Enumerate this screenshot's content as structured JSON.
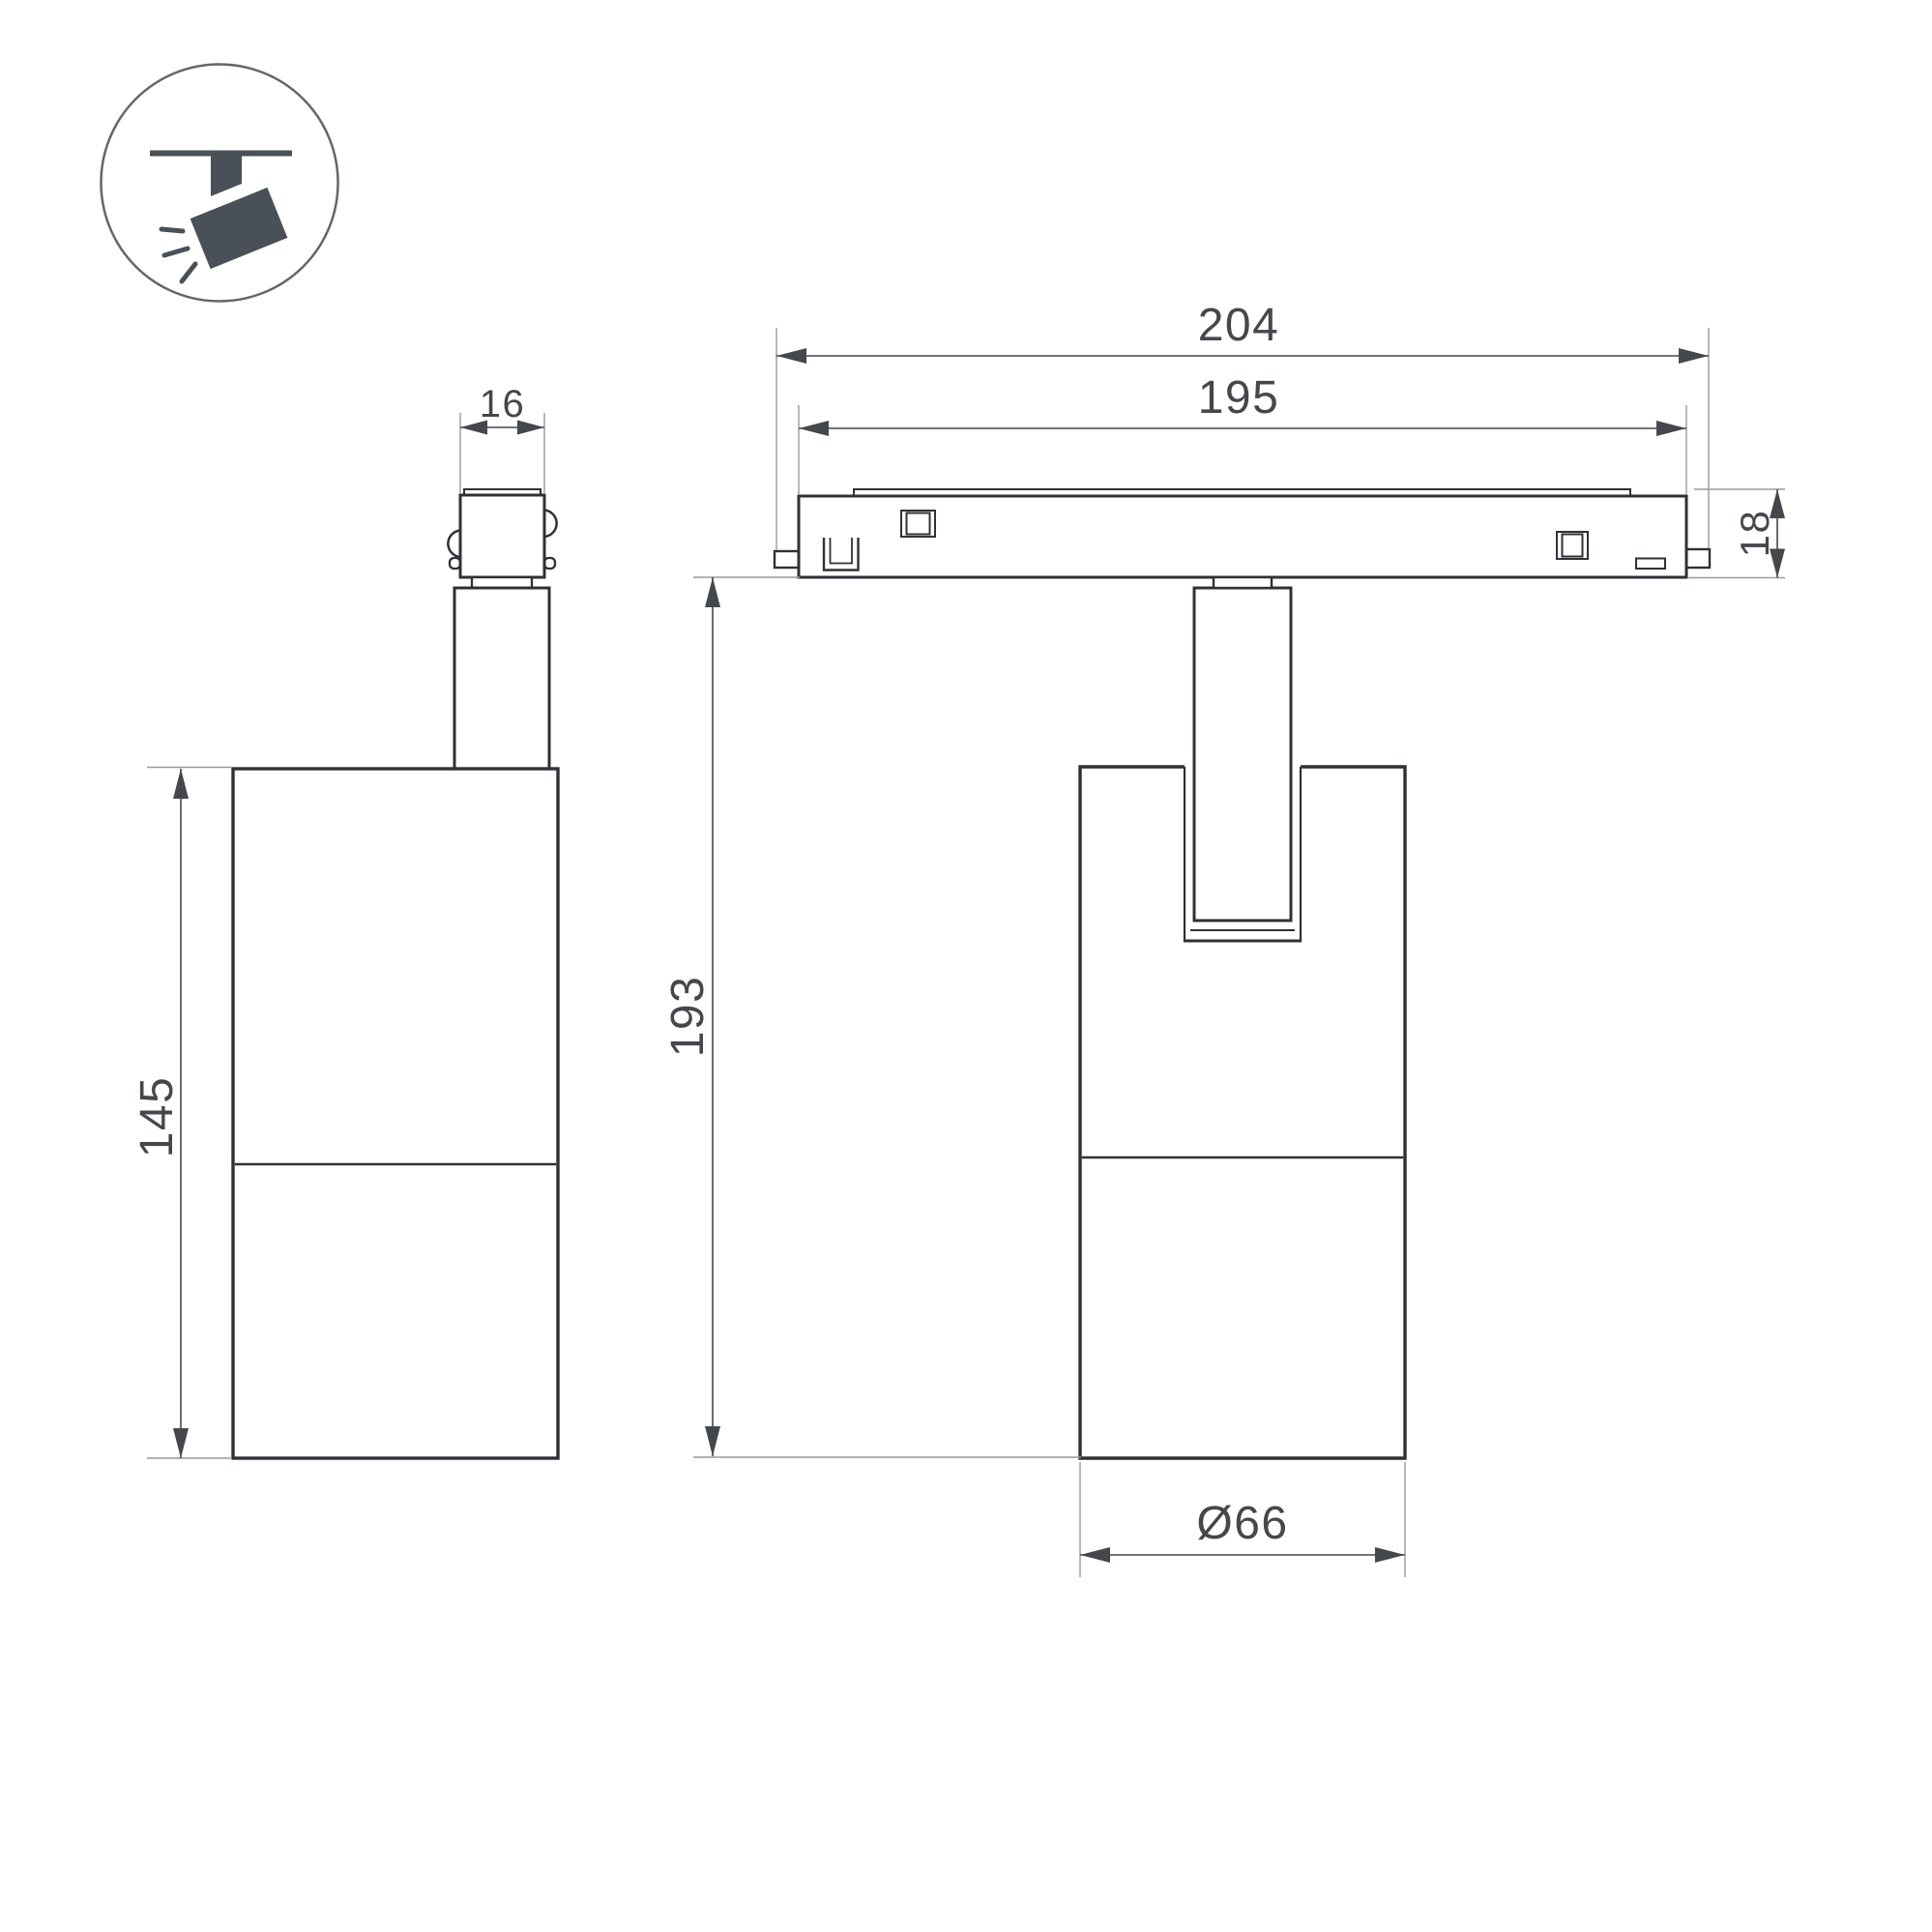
{
  "title": "Ceiling track spotlight dimension drawing",
  "colors": {
    "outline": "#2e3136",
    "dimension": "#44474c",
    "extension": "#97999c",
    "icon_fill": "#495058",
    "background": "#ffffff"
  },
  "icon": {
    "label": "track-spotlight"
  },
  "views": {
    "left": "side view",
    "right": "front view"
  },
  "dimensions": {
    "connector_width": "16",
    "track_overall": "204",
    "track_body": "195",
    "track_height": "18",
    "body_height": "145",
    "overall_height": "193",
    "diameter": "Ø66"
  }
}
